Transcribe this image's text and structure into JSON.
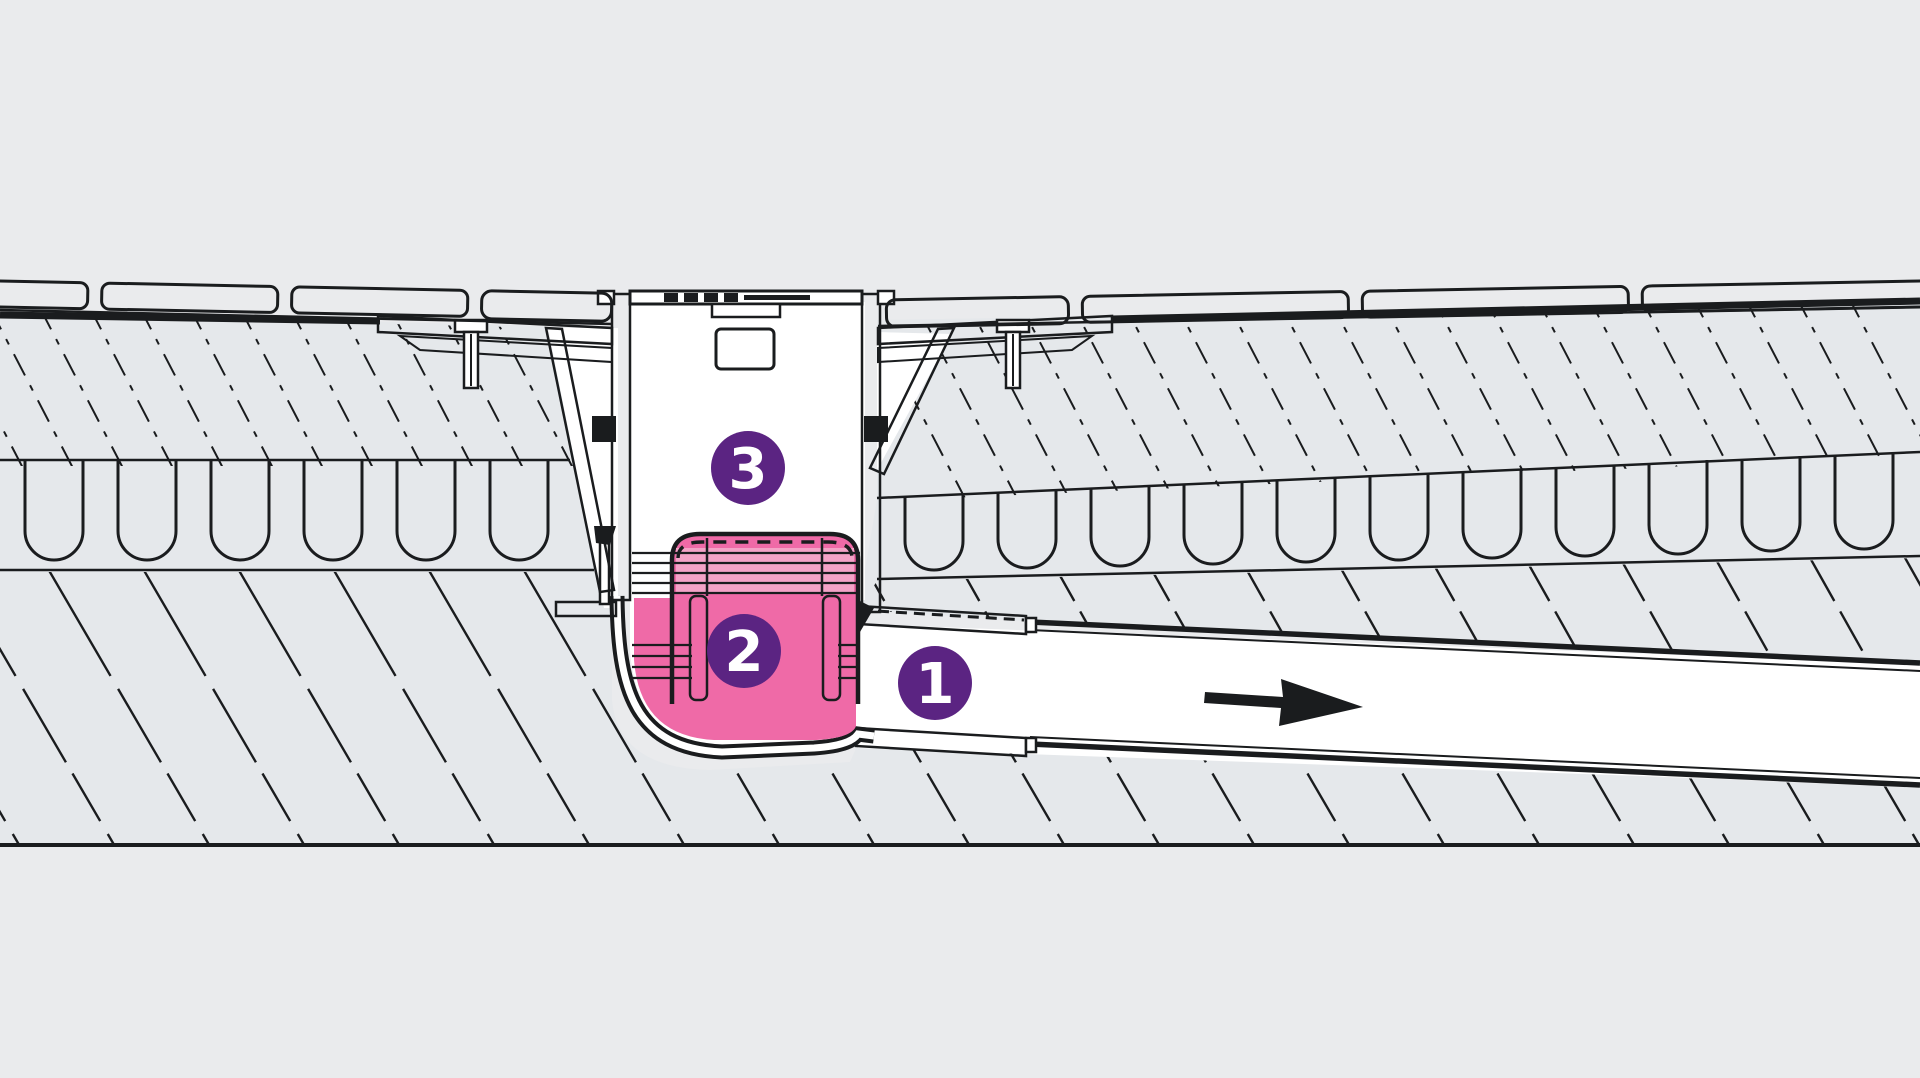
{
  "diagram": {
    "type": "floor-drain-cross-section",
    "callouts": [
      {
        "id": 1,
        "label": "1",
        "points_to": "outlet-pipe"
      },
      {
        "id": 2,
        "label": "2",
        "points_to": "odour-trap"
      },
      {
        "id": 3,
        "label": "3",
        "points_to": "drain-body"
      }
    ],
    "flow_arrow": {
      "direction": "right"
    }
  },
  "colors": {
    "background": "#eaebed",
    "layer_fill": "#e5e8eb",
    "tile_fill": "#e2e6e9",
    "line": "#1a1c1e",
    "badge_purple": "#5b2482",
    "badge_number": "#ffffff",
    "trap_pink": "#ef6aa7",
    "trap_pink_light": "#f4a3c7",
    "pipe_white": "#ffffff"
  }
}
